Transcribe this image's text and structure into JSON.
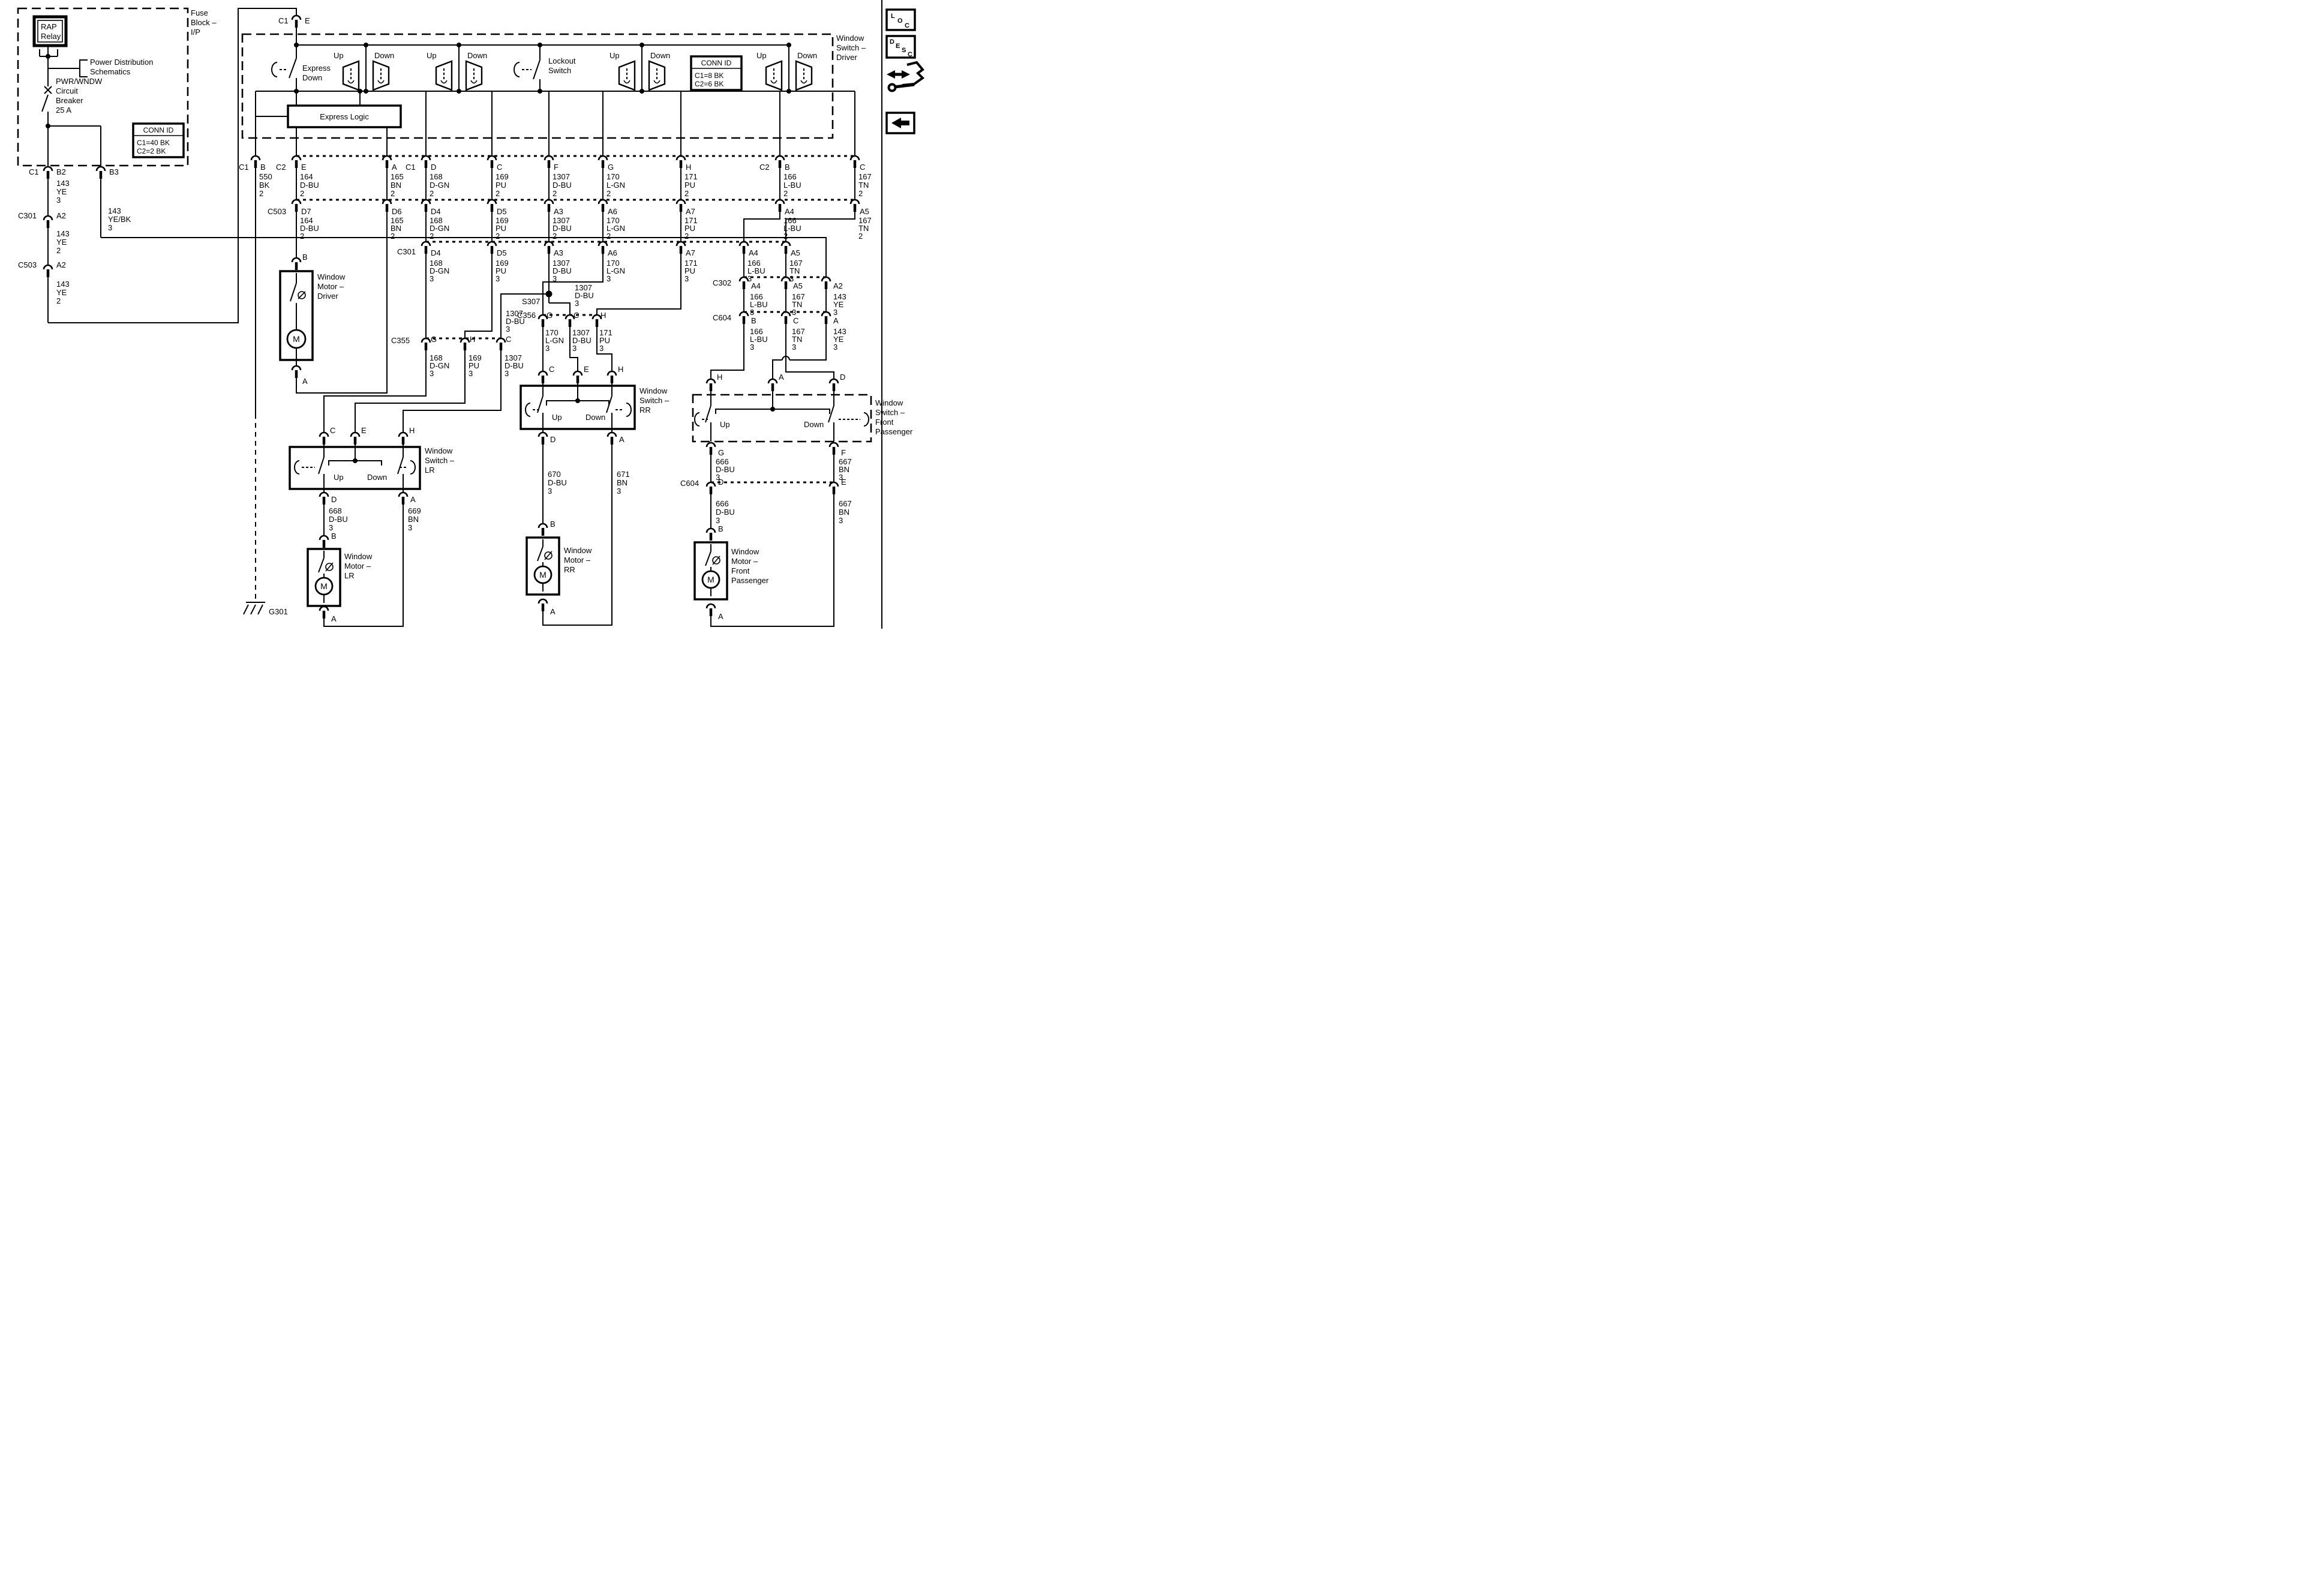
{
  "labels": {
    "up": "Up",
    "down": "Down"
  },
  "fuse_block": {
    "title_l1": "Fuse",
    "title_l2": "Block –",
    "title_l3": "I/P",
    "relay_l1": "RAP",
    "relay_l2": "Relay",
    "power_l1": "Power Distribution",
    "power_l2": "Schematics",
    "breaker_l1": "PWR/WNDW",
    "breaker_l2": "Circuit",
    "breaker_l3": "Breaker",
    "breaker_l4": "25 A",
    "conn_title": "CONN ID",
    "conn_r1": "C1=40 BK",
    "conn_r2": "C2=2 BK"
  },
  "left_chain": {
    "c1": "C1",
    "b2": "B2",
    "b3": "B3",
    "w143ye3": [
      "143",
      "YE",
      "3"
    ],
    "c301": "C301",
    "a2_1": "A2",
    "w143ye2a": [
      "143",
      "YE",
      "2"
    ],
    "c503": "C503",
    "a2_2": "A2",
    "w143ye2b": [
      "143",
      "YE",
      "2"
    ],
    "w143yebk": [
      "143",
      "YE/BK",
      "3"
    ]
  },
  "driver_switch": {
    "conn_c1": "C1",
    "pin_e": "E",
    "label": [
      "Window",
      "Switch –",
      "Driver"
    ],
    "express_l1": "Express",
    "express_l2": "Down",
    "logic": "Express Logic",
    "lockout_l1": "Lockout",
    "lockout_l2": "Switch",
    "conn_title": "CONN ID",
    "conn_r1": "C1=8 BK",
    "conn_r2": "C2=6 BK"
  },
  "row1": {
    "pre_b": "C1",
    "pre_e": "C2",
    "pre_d": "C1",
    "pre_b2": "C2",
    "pins": [
      [
        "B",
        "550",
        "BK",
        "2"
      ],
      [
        "E",
        "164",
        "D-BU",
        "2"
      ],
      [
        "A",
        "165",
        "BN",
        "2"
      ],
      [
        "D",
        "168",
        "D-GN",
        "2"
      ],
      [
        "C",
        "169",
        "PU",
        "2"
      ],
      [
        "F",
        "1307",
        "D-BU",
        "2"
      ],
      [
        "G",
        "170",
        "L-GN",
        "2"
      ],
      [
        "H",
        "171",
        "PU",
        "2"
      ],
      [
        "B",
        "166",
        "L-BU",
        "2"
      ],
      [
        "C",
        "167",
        "TN",
        "2"
      ]
    ]
  },
  "row2": {
    "conn": "C503",
    "pins": [
      [
        "D7",
        "164",
        "D-BU",
        "2"
      ],
      [
        "D6",
        "165",
        "BN",
        "2"
      ],
      [
        "D4",
        "168",
        "D-GN",
        "2"
      ],
      [
        "D5",
        "169",
        "PU",
        "2"
      ],
      [
        "A3",
        "1307",
        "D-BU",
        "2"
      ],
      [
        "A6",
        "170",
        "L-GN",
        "2"
      ],
      [
        "A7",
        "171",
        "PU",
        "2"
      ],
      [
        "A4",
        "166",
        "L-BU",
        "2"
      ],
      [
        "A5",
        "167",
        "TN",
        "2"
      ]
    ]
  },
  "row3": {
    "conn": "C301",
    "pins": [
      [
        "D4",
        "168",
        "D-GN",
        "3"
      ],
      [
        "D5",
        "169",
        "PU",
        "3"
      ],
      [
        "A3",
        "1307",
        "D-BU",
        "3"
      ],
      [
        "A6",
        "170",
        "L-GN",
        "3"
      ],
      [
        "A7",
        "171",
        "PU",
        "3"
      ],
      [
        "A4",
        "166",
        "L-BU",
        "3"
      ],
      [
        "A5",
        "167",
        "TN",
        "3"
      ]
    ]
  },
  "s307": {
    "label": "S307",
    "w_left": [
      "1307",
      "D-BU",
      "3"
    ],
    "w_right": [
      "1307",
      "D-BU",
      "3"
    ]
  },
  "c355": {
    "conn": "C355",
    "g": "G",
    "h": "H",
    "c": "C",
    "w_g": [
      "168",
      "D-GN",
      "3"
    ],
    "w_h": [
      "169",
      "PU",
      "3"
    ],
    "w_c": [
      "1307",
      "D-BU",
      "3"
    ]
  },
  "c356": {
    "conn": "C356",
    "g": "G",
    "c": "C",
    "h": "H",
    "w_g": [
      "170",
      "L-GN",
      "3"
    ],
    "w_c": [
      "1307",
      "D-BU",
      "3"
    ],
    "w_h": [
      "171",
      "PU",
      "3"
    ]
  },
  "c302": {
    "conn": "C302",
    "p": [
      "A4",
      "A5",
      "A2"
    ],
    "w": [
      [
        "166",
        "L-BU",
        "3"
      ],
      [
        "167",
        "TN",
        "3"
      ],
      [
        "143",
        "YE",
        "3"
      ]
    ]
  },
  "c604a": {
    "conn": "C604",
    "p": [
      "B",
      "C",
      "A"
    ],
    "w": [
      [
        "166",
        "L-BU",
        "3"
      ],
      [
        "167",
        "TN",
        "3"
      ],
      [
        "143",
        "YE",
        "3"
      ]
    ]
  },
  "lr": {
    "label": [
      "Window",
      "Switch –",
      "LR"
    ],
    "c": "C",
    "e": "E",
    "h": "H",
    "d": "D",
    "a": "A",
    "w_d": [
      "668",
      "D-BU",
      "3"
    ],
    "w_a": [
      "669",
      "BN",
      "3"
    ],
    "motor": [
      "Window",
      "Motor –",
      "LR"
    ]
  },
  "rr": {
    "label": [
      "Window",
      "Switch –",
      "RR"
    ],
    "c": "C",
    "e": "E",
    "h": "H",
    "d": "D",
    "a": "A",
    "w_d": [
      "670",
      "D-BU",
      "3"
    ],
    "w_a": [
      "671",
      "BN",
      "3"
    ],
    "motor": [
      "Window",
      "Motor –",
      "RR"
    ]
  },
  "fp": {
    "label": [
      "Window",
      "Switch –",
      "Front",
      "Passenger"
    ],
    "h": "H",
    "a": "A",
    "d": "D",
    "g": "G",
    "f": "F",
    "w_g": [
      "666",
      "D-BU",
      "3"
    ],
    "w_f": [
      "667",
      "BN",
      "3"
    ],
    "c604": "C604",
    "cd": "D",
    "ce": "E",
    "w_g2": [
      "666",
      "D-BU",
      "3"
    ],
    "w_f2": [
      "667",
      "BN",
      "3"
    ],
    "motor": [
      "Window",
      "Motor –",
      "Front",
      "Passenger"
    ]
  },
  "motor_common": {
    "m": "M",
    "b": "B",
    "a": "A"
  },
  "driver_motor": {
    "label": [
      "Window",
      "Motor –",
      "Driver"
    ]
  },
  "ground": {
    "label": "G301"
  },
  "sidebar": {
    "loc": [
      "L",
      "O",
      "C"
    ],
    "desc": [
      "D",
      "E",
      "S",
      "C"
    ]
  }
}
